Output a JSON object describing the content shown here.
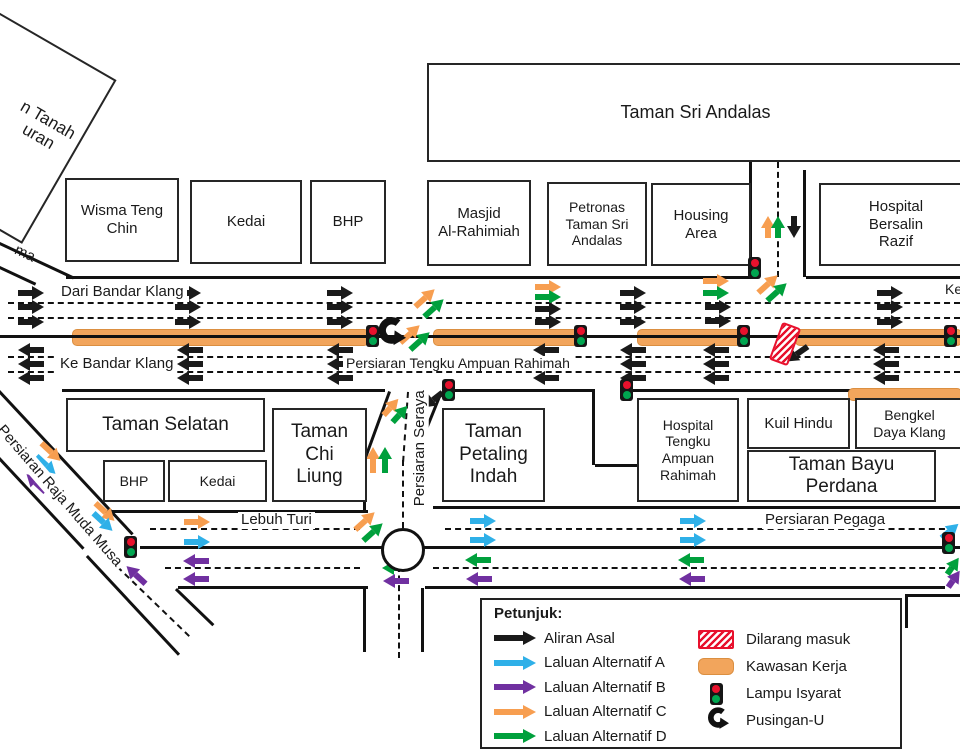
{
  "colors": {
    "k": "#1a1a1a",
    "b": "#2fb0e8",
    "p": "#7030a0",
    "o": "#f79e50",
    "g": "#00a03c",
    "work": "#f2a55c",
    "workBorder": "#db8f41",
    "red": "#e8112d"
  },
  "buildings": [
    {
      "id": "taman-sri-andalas",
      "label": "Taman Sri Andalas",
      "x": 427,
      "y": 63,
      "w": 533,
      "h": 95,
      "fs": 18
    },
    {
      "id": "wisma-teng-chin",
      "label": "Wisma Teng\nChin",
      "x": 65,
      "y": 178,
      "w": 110,
      "h": 80,
      "fs": 15
    },
    {
      "id": "kedai-north",
      "label": "Kedai",
      "x": 190,
      "y": 180,
      "w": 108,
      "h": 80,
      "fs": 15
    },
    {
      "id": "bhp-north",
      "label": "BHP",
      "x": 310,
      "y": 180,
      "w": 72,
      "h": 80,
      "fs": 15
    },
    {
      "id": "masjid-al-rahimiah",
      "label": "Masjid\nAl-Rahimiah",
      "x": 427,
      "y": 180,
      "w": 100,
      "h": 82,
      "fs": 15
    },
    {
      "id": "petronas-taman-sri-andalas",
      "label": "Petronas\nTaman Sri\nAndalas",
      "x": 547,
      "y": 182,
      "w": 96,
      "h": 80,
      "fs": 14
    },
    {
      "id": "housing-area",
      "label": "Housing\nArea",
      "x": 651,
      "y": 183,
      "w": 96,
      "h": 79,
      "fs": 15
    },
    {
      "id": "hospital-bersalin-razif",
      "label": "Hospital\nBersalin\nRazif",
      "x": 819,
      "y": 183,
      "w": 150,
      "h": 79,
      "fs": 15
    },
    {
      "id": "taman-selatan",
      "label": "Taman Selatan",
      "x": 66,
      "y": 398,
      "w": 195,
      "h": 50,
      "fs": 19
    },
    {
      "id": "bhp-south",
      "label": "BHP",
      "x": 103,
      "y": 460,
      "w": 58,
      "h": 38,
      "fs": 14
    },
    {
      "id": "kedai-south",
      "label": "Kedai",
      "x": 168,
      "y": 460,
      "w": 95,
      "h": 38,
      "fs": 14
    },
    {
      "id": "taman-chi-liung",
      "label": "Taman\nChi\nLiung",
      "x": 272,
      "y": 408,
      "w": 91,
      "h": 90,
      "fs": 19
    },
    {
      "id": "taman-petaling-indah",
      "label": "Taman\nPetaling\nIndah",
      "x": 442,
      "y": 408,
      "w": 99,
      "h": 90,
      "fs": 19
    },
    {
      "id": "hospital-tengku-ampuan-rahimah",
      "label": "Hospital\nTengku\nAmpuan\nRahimah",
      "x": 637,
      "y": 398,
      "w": 98,
      "h": 100,
      "fs": 14
    },
    {
      "id": "kuil-hindu",
      "label": "Kuil Hindu",
      "x": 747,
      "y": 398,
      "w": 99,
      "h": 47,
      "fs": 15
    },
    {
      "id": "bengkel-daya-klang",
      "label": "Bengkel\nDaya Klang",
      "x": 855,
      "y": 398,
      "w": 105,
      "h": 47,
      "fs": 14
    },
    {
      "id": "taman-bayu-perdana",
      "label": "Taman Bayu\nPerdana",
      "x": 747,
      "y": 450,
      "w": 185,
      "h": 48,
      "fs": 19
    },
    {
      "id": "rotated-office-block",
      "label": "",
      "x": -149,
      "y": 9,
      "w": 230,
      "h": 185,
      "fs": 17,
      "rot": 30
    }
  ],
  "road_labels": [
    {
      "id": "dari-bandar-klang",
      "t": "Dari Bandar Klang",
      "x": 58,
      "y": 284,
      "fs": 15
    },
    {
      "id": "ke-bandar-klang",
      "t": "Ke Bandar Klang",
      "x": 57,
      "y": 356,
      "fs": 15
    },
    {
      "id": "persiaran-tengku-ampuan-rahimah",
      "t": "Persiaran Tengku Ampuan Rahimah",
      "x": 343,
      "y": 356,
      "fs": 14
    },
    {
      "id": "ke-fragment",
      "t": "Ke",
      "x": 942,
      "y": 282,
      "fs": 14
    },
    {
      "id": "lebuh-turi",
      "t": "Lebuh Turi",
      "x": 238,
      "y": 512,
      "fs": 15
    },
    {
      "id": "persiaran-pegaga",
      "t": "Persiaran Pegaga",
      "x": 762,
      "y": 512,
      "fs": 15
    },
    {
      "id": "persiaran-seraya",
      "t": "Persiaran Seraya",
      "x": 352,
      "y": 440,
      "fs": 15,
      "rot": -90,
      "w": 130
    },
    {
      "id": "persiaran-raja-muda-musa",
      "t": "Persiaran Raja Muda Musa",
      "x": 4,
      "y": 420,
      "fs": 15,
      "rot": 49,
      "origin": "left"
    },
    {
      "id": "road-name-fragment-ma",
      "t": "ma",
      "x": 16,
      "y": 241,
      "fs": 15,
      "rot": 25,
      "origin": "left",
      "nobg": true
    },
    {
      "id": "office-label-fragment",
      "t": "n Tanah\nuran",
      "x": -8,
      "y": 110,
      "fs": 17,
      "rot": 30,
      "w": 96,
      "nobg": true
    }
  ],
  "map": {
    "lines": [
      [
        66,
        276,
        686,
        0,
        "s"
      ],
      [
        806,
        276,
        154,
        0,
        "s"
      ],
      [
        8,
        302,
        952,
        0,
        "d"
      ],
      [
        8,
        317,
        952,
        0,
        "d"
      ],
      [
        0,
        335,
        960,
        0,
        "c"
      ],
      [
        8,
        356,
        952,
        0,
        "d"
      ],
      [
        8,
        371,
        952,
        0,
        "d"
      ],
      [
        62,
        389,
        323,
        0,
        "s"
      ],
      [
        445,
        389,
        150,
        0,
        "s"
      ],
      [
        633,
        389,
        327,
        0,
        "s"
      ],
      [
        752,
        162,
        115,
        90,
        "s"
      ],
      [
        806,
        170,
        107,
        90,
        "s"
      ],
      [
        779,
        162,
        115,
        90,
        "d"
      ],
      [
        595,
        390,
        75,
        90,
        "s"
      ],
      [
        595,
        464,
        42,
        0,
        "s"
      ],
      [
        391,
        392,
        72,
        110,
        "s"
      ],
      [
        366,
        458,
        53,
        90,
        "s"
      ],
      [
        443,
        392,
        41,
        112,
        "s"
      ],
      [
        428,
        428,
        80,
        90,
        "s"
      ],
      [
        409,
        392,
        70,
        94,
        "d"
      ],
      [
        404,
        460,
        68,
        90,
        "d"
      ],
      [
        400,
        566,
        92,
        90,
        "d"
      ],
      [
        366,
        588,
        64,
        90,
        "s"
      ],
      [
        424,
        588,
        64,
        90,
        "s"
      ],
      [
        102,
        510,
        266,
        0,
        "s"
      ],
      [
        433,
        506,
        527,
        0,
        "s"
      ],
      [
        150,
        528,
        210,
        0,
        "d"
      ],
      [
        445,
        528,
        510,
        0,
        "d"
      ],
      [
        140,
        546,
        243,
        0,
        "c"
      ],
      [
        417,
        546,
        543,
        0,
        "c"
      ],
      [
        165,
        567,
        195,
        0,
        "d"
      ],
      [
        433,
        567,
        522,
        0,
        "d"
      ],
      [
        178,
        586,
        190,
        0,
        "s"
      ],
      [
        425,
        586,
        520,
        0,
        "s"
      ],
      [
        908,
        594,
        52,
        0,
        "s"
      ],
      [
        908,
        594,
        34,
        90,
        "s"
      ],
      [
        0,
        390,
        196,
        47,
        "s"
      ],
      [
        0,
        457,
        124,
        47,
        "s"
      ],
      [
        88,
        555,
        135,
        47,
        "s"
      ],
      [
        118,
        566,
        100,
        44,
        "d"
      ],
      [
        177,
        588,
        52,
        44,
        "s"
      ],
      [
        0,
        242,
        82,
        25,
        "s"
      ],
      [
        0,
        266,
        40,
        25,
        "s"
      ]
    ],
    "work_zones": [
      [
        72,
        329,
        295,
        15
      ],
      [
        433,
        329,
        144,
        15
      ],
      [
        637,
        329,
        103,
        15
      ],
      [
        795,
        329,
        165,
        15
      ],
      [
        848,
        388,
        112,
        11
      ]
    ],
    "traffic_lights": [
      [
        748,
        257
      ],
      [
        366,
        325
      ],
      [
        574,
        325
      ],
      [
        737,
        325
      ],
      [
        944,
        325
      ],
      [
        442,
        379
      ],
      [
        620,
        379
      ],
      [
        124,
        536
      ],
      [
        942,
        532
      ]
    ],
    "arrows": [
      [
        31,
        293,
        0,
        "k"
      ],
      [
        31,
        307,
        0,
        "k"
      ],
      [
        31,
        322,
        0,
        "k"
      ],
      [
        188,
        293,
        0,
        "k"
      ],
      [
        188,
        307,
        0,
        "k"
      ],
      [
        188,
        322,
        0,
        "k"
      ],
      [
        340,
        293,
        0,
        "k"
      ],
      [
        340,
        307,
        0,
        "k"
      ],
      [
        340,
        322,
        0,
        "k"
      ],
      [
        633,
        293,
        0,
        "k"
      ],
      [
        633,
        307,
        0,
        "k"
      ],
      [
        633,
        322,
        0,
        "k"
      ],
      [
        890,
        293,
        0,
        "k"
      ],
      [
        890,
        307,
        0,
        "k"
      ],
      [
        890,
        322,
        0,
        "k"
      ],
      [
        548,
        287,
        0,
        "o"
      ],
      [
        548,
        297,
        0,
        "g"
      ],
      [
        548,
        309,
        0,
        "k"
      ],
      [
        548,
        322,
        0,
        "k"
      ],
      [
        716,
        281,
        0,
        "o"
      ],
      [
        716,
        293,
        0,
        "g"
      ],
      [
        718,
        307,
        0,
        "k"
      ],
      [
        718,
        321,
        0,
        "k"
      ],
      [
        31,
        350,
        180,
        "k"
      ],
      [
        31,
        364,
        180,
        "k"
      ],
      [
        31,
        378,
        180,
        "k"
      ],
      [
        190,
        350,
        180,
        "k"
      ],
      [
        190,
        364,
        180,
        "k"
      ],
      [
        190,
        378,
        180,
        "k"
      ],
      [
        340,
        350,
        180,
        "k"
      ],
      [
        340,
        364,
        180,
        "k"
      ],
      [
        340,
        378,
        180,
        "k"
      ],
      [
        546,
        350,
        180,
        "k"
      ],
      [
        546,
        364,
        180,
        "k"
      ],
      [
        546,
        378,
        180,
        "k"
      ],
      [
        633,
        350,
        180,
        "k"
      ],
      [
        633,
        364,
        180,
        "k"
      ],
      [
        633,
        378,
        180,
        "k"
      ],
      [
        716,
        350,
        180,
        "k"
      ],
      [
        716,
        364,
        180,
        "k"
      ],
      [
        716,
        378,
        180,
        "k"
      ],
      [
        886,
        350,
        180,
        "k"
      ],
      [
        886,
        364,
        180,
        "k"
      ],
      [
        886,
        378,
        180,
        "k"
      ],
      [
        425,
        298,
        -42,
        "o"
      ],
      [
        434,
        308,
        -42,
        "g"
      ],
      [
        410,
        334,
        -42,
        "o"
      ],
      [
        420,
        341,
        -42,
        "g"
      ],
      [
        768,
        284,
        -42,
        "o"
      ],
      [
        777,
        292,
        -42,
        "g"
      ],
      [
        768,
        227,
        -90,
        "o",
        22
      ],
      [
        778,
        227,
        -90,
        "g",
        22
      ],
      [
        794,
        227,
        90,
        "k",
        22
      ],
      [
        373,
        460,
        -90,
        "o"
      ],
      [
        385,
        460,
        -90,
        "g"
      ],
      [
        391,
        407,
        -48,
        "o",
        22
      ],
      [
        400,
        414,
        -48,
        "g",
        22
      ],
      [
        433,
        400,
        142,
        "k",
        24
      ],
      [
        797,
        354,
        145,
        "k",
        26
      ],
      [
        51,
        452,
        43,
        "o"
      ],
      [
        46,
        465,
        43,
        "b"
      ],
      [
        105,
        512,
        43,
        "o"
      ],
      [
        103,
        522,
        43,
        "b"
      ],
      [
        36,
        483,
        223,
        "p"
      ],
      [
        136,
        575,
        223,
        "p"
      ],
      [
        197,
        522,
        0,
        "o"
      ],
      [
        197,
        542,
        0,
        "b"
      ],
      [
        196,
        561,
        180,
        "p"
      ],
      [
        196,
        579,
        180,
        "p"
      ],
      [
        365,
        521,
        -42,
        "o"
      ],
      [
        373,
        532,
        -42,
        "g"
      ],
      [
        483,
        521,
        0,
        "b"
      ],
      [
        483,
        540,
        0,
        "b"
      ],
      [
        693,
        521,
        0,
        "b"
      ],
      [
        693,
        540,
        0,
        "b"
      ],
      [
        478,
        560,
        180,
        "g"
      ],
      [
        691,
        560,
        180,
        "g"
      ],
      [
        479,
        579,
        180,
        "p"
      ],
      [
        692,
        579,
        180,
        "p"
      ],
      [
        950,
        531,
        -40,
        "b",
        22
      ],
      [
        953,
        566,
        -55,
        "g",
        20
      ],
      [
        954,
        579,
        -55,
        "p",
        20
      ],
      [
        395,
        568,
        180,
        "g"
      ],
      [
        396,
        581,
        180,
        "p"
      ]
    ],
    "roundabout": {
      "x": 381,
      "y": 528,
      "d": 38
    },
    "no_entry": {
      "x": 775,
      "y": 324,
      "w": 16,
      "h": 36,
      "rot": 20
    },
    "u_turn": {
      "x": 372,
      "y": 314,
      "size": 34
    }
  },
  "legend": {
    "title": "Petunjuk:",
    "x": 480,
    "y": 598,
    "w": 418,
    "h": 147,
    "flows": [
      {
        "label": "Aliran Asal",
        "color": "#1a1a1a"
      },
      {
        "label": "Laluan Alternatif A",
        "color": "#2fb0e8"
      },
      {
        "label": "Laluan Alternatif B",
        "color": "#7030a0"
      },
      {
        "label": "Laluan Alternatif C",
        "color": "#f79e50"
      },
      {
        "label": "Laluan Alternatif D",
        "color": "#00a03c"
      }
    ],
    "symbols": [
      {
        "label": "Dilarang masuk",
        "type": "noentry"
      },
      {
        "label": "Kawasan Kerja",
        "type": "kawasan"
      },
      {
        "label": "Lampu Isyarat",
        "type": "light"
      },
      {
        "label": "Pusingan-U",
        "type": "uturn"
      }
    ]
  }
}
